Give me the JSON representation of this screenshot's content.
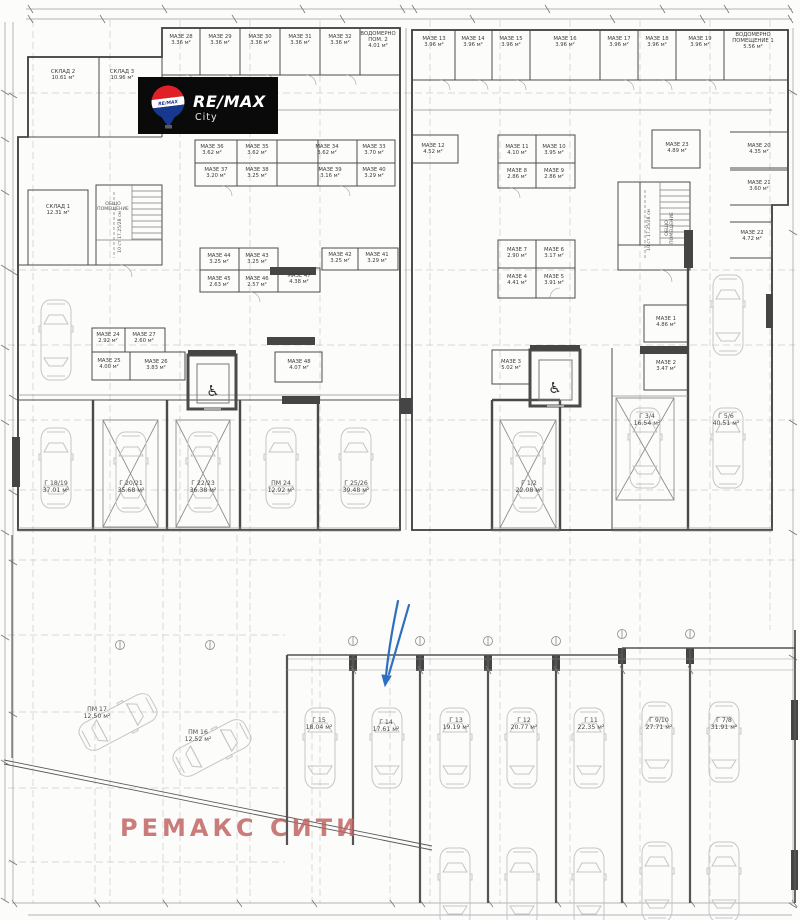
{
  "brand": {
    "logo_text": "RE/MAX",
    "logo_sub": "City",
    "balloon_text": "RE/MAX",
    "colors": {
      "red": "#e01f26",
      "blue": "#16388e",
      "black": "#0a0a0a"
    }
  },
  "watermark": {
    "text": "РЕМАКС СИТИ",
    "color": "#c06060"
  },
  "annotation": {
    "arrow_color": "#2f6fc0"
  },
  "plan": {
    "rooms": [
      {
        "label": "СКЛАД 2",
        "area": "10.61 м²",
        "x": 63,
        "y": 73
      },
      {
        "label": "СКЛАД 3",
        "area": "10.96 м²",
        "x": 122,
        "y": 73
      },
      {
        "label": "СКЛАД 1",
        "area": "12.31 м²",
        "x": 58,
        "y": 208
      },
      {
        "label": "МАЗЕ 28",
        "area": "3.36 м²",
        "x": 181,
        "y": 38
      },
      {
        "label": "МАЗЕ 29",
        "area": "3.36 м²",
        "x": 220,
        "y": 38
      },
      {
        "label": "МАЗЕ 30",
        "area": "3.36 м²",
        "x": 260,
        "y": 38
      },
      {
        "label": "МАЗЕ 31",
        "area": "3.36 м²",
        "x": 300,
        "y": 38
      },
      {
        "label": "МАЗЕ 32",
        "area": "3.36 м²",
        "x": 340,
        "y": 38
      },
      {
        "label": "ВОДОМЕРНО",
        "label2": "ПОМ. 2",
        "area": "4.01 м²",
        "x": 378,
        "y": 35
      },
      {
        "label": "МАЗЕ 13",
        "area": "3.96 м²",
        "x": 434,
        "y": 40
      },
      {
        "label": "МАЗЕ 14",
        "area": "3.96 м²",
        "x": 473,
        "y": 40
      },
      {
        "label": "МАЗЕ 15",
        "area": "3.96 м²",
        "x": 511,
        "y": 40
      },
      {
        "label": "МАЗЕ 16",
        "area": "3.96 м²",
        "x": 565,
        "y": 40
      },
      {
        "label": "МАЗЕ 17",
        "area": "3.96 м²",
        "x": 619,
        "y": 40
      },
      {
        "label": "МАЗЕ 18",
        "area": "3.96 м²",
        "x": 657,
        "y": 40
      },
      {
        "label": "МАЗЕ 19",
        "area": "3.96 м²",
        "x": 700,
        "y": 40
      },
      {
        "label": "ВОДОМЕРНО",
        "label2": "ПОМЕЩЕНИЕ 1",
        "area": "5.56 м²",
        "x": 753,
        "y": 36
      },
      {
        "label": "МАЗЕ 36",
        "area": "3.62 м²",
        "x": 212,
        "y": 148
      },
      {
        "label": "МАЗЕ 35",
        "area": "3.62 м²",
        "x": 257,
        "y": 148
      },
      {
        "label": "МАЗЕ 34",
        "area": "3.62 м²",
        "x": 327,
        "y": 148
      },
      {
        "label": "МАЗЕ 33",
        "area": "3.70 м²",
        "x": 374,
        "y": 148
      },
      {
        "label": "МАЗЕ 37",
        "area": "3.20 м²",
        "x": 216,
        "y": 171
      },
      {
        "label": "МАЗЕ 38",
        "area": "3.25 м²",
        "x": 257,
        "y": 171
      },
      {
        "label": "МАЗЕ 39",
        "area": "3.16 м²",
        "x": 330,
        "y": 171
      },
      {
        "label": "МАЗЕ 40",
        "area": "3.29 м²",
        "x": 374,
        "y": 171
      },
      {
        "label": "МАЗЕ 12",
        "area": "4.52 м²",
        "x": 433,
        "y": 147
      },
      {
        "label": "МАЗЕ 11",
        "area": "4.10 м²",
        "x": 517,
        "y": 148
      },
      {
        "label": "МАЗЕ 10",
        "area": "3.95 м²",
        "x": 554,
        "y": 148
      },
      {
        "label": "МАЗЕ 8",
        "area": "2.86 м²",
        "x": 517,
        "y": 172
      },
      {
        "label": "МАЗЕ 9",
        "area": "2.86 м²",
        "x": 554,
        "y": 172
      },
      {
        "label": "МАЗЕ 23",
        "area": "4.89 м²",
        "x": 677,
        "y": 146
      },
      {
        "label": "МАЗЕ 20",
        "area": "4.35 м²",
        "x": 759,
        "y": 147
      },
      {
        "label": "МАЗЕ 21",
        "area": "3.60 м²",
        "x": 759,
        "y": 184
      },
      {
        "label": "МАЗЕ 22",
        "area": "4.72 м²",
        "x": 752,
        "y": 234
      },
      {
        "label": "МАЗЕ 44",
        "area": "3.25 м²",
        "x": 219,
        "y": 257
      },
      {
        "label": "МАЗЕ 43",
        "area": "3.25 м²",
        "x": 257,
        "y": 257
      },
      {
        "label": "МАЗЕ 42",
        "area": "3.25 м²",
        "x": 340,
        "y": 256
      },
      {
        "label": "МАЗЕ 41",
        "area": "3.29 м²",
        "x": 377,
        "y": 256
      },
      {
        "label": "МАЗЕ 45",
        "area": "2.63 м²",
        "x": 219,
        "y": 280
      },
      {
        "label": "МАЗЕ 46",
        "area": "2.57 м²",
        "x": 257,
        "y": 280
      },
      {
        "label": "МАЗЕ 47",
        "area": "4.38 м²",
        "x": 299,
        "y": 277
      },
      {
        "label": "МАЗЕ 7",
        "area": "2.90 м²",
        "x": 517,
        "y": 251
      },
      {
        "label": "МАЗЕ 6",
        "area": "3.17 м²",
        "x": 554,
        "y": 251
      },
      {
        "label": "МАЗЕ 4",
        "area": "4.41 м²",
        "x": 517,
        "y": 278
      },
      {
        "label": "МАЗЕ 5",
        "area": "3.91 м²",
        "x": 554,
        "y": 278
      },
      {
        "label": "МАЗЕ 24",
        "area": "2.92 м²",
        "x": 108,
        "y": 336
      },
      {
        "label": "МАЗЕ 27",
        "area": "2.60 м²",
        "x": 144,
        "y": 336
      },
      {
        "label": "МАЗЕ 25",
        "area": "4.00 м²",
        "x": 109,
        "y": 362
      },
      {
        "label": "МАЗЕ 26",
        "area": "3.83 м²",
        "x": 156,
        "y": 363
      },
      {
        "label": "МАЗЕ 48",
        "area": "4.07 м²",
        "x": 299,
        "y": 363
      },
      {
        "label": "МАЗЕ 3",
        "area": "5.02 м²",
        "x": 511,
        "y": 363
      },
      {
        "label": "МАЗЕ 1",
        "area": "4.86 м²",
        "x": 666,
        "y": 320
      },
      {
        "label": "МАЗЕ 2",
        "area": "3.47 м²",
        "x": 666,
        "y": 364
      }
    ],
    "garages": [
      {
        "label": "Г 18/19",
        "area": "37.01 м²",
        "x": 56,
        "y": 485
      },
      {
        "label": "Г 20/21",
        "area": "35.68 м²",
        "x": 131,
        "y": 485
      },
      {
        "label": "Г 22/23",
        "area": "36.38 м²",
        "x": 203,
        "y": 485
      },
      {
        "label": "ПМ 24",
        "area": "12.92 м²",
        "x": 281,
        "y": 485
      },
      {
        "label": "Г 25/26",
        "area": "39.48 м²",
        "x": 356,
        "y": 485
      },
      {
        "label": "Г 1/2",
        "area": "22.08 м²",
        "x": 529,
        "y": 485
      },
      {
        "label": "Г 3/4",
        "area": "16.54 м²",
        "x": 647,
        "y": 418
      },
      {
        "label": "Г 5/6",
        "area": "40.51 м²",
        "x": 726,
        "y": 418
      },
      {
        "label": "ПМ 17",
        "area": "12.50 м²",
        "x": 97,
        "y": 711
      },
      {
        "label": "ПМ 16",
        "area": "12.52 м²",
        "x": 198,
        "y": 734
      },
      {
        "label": "Г 15",
        "area": "18.04 м²",
        "x": 319,
        "y": 722
      },
      {
        "label": "Г 14",
        "area": "17.61 м²",
        "x": 386,
        "y": 724
      },
      {
        "label": "Г 13",
        "area": "19.19 м²",
        "x": 456,
        "y": 722
      },
      {
        "label": "Г 12",
        "area": "20.77 м²",
        "x": 524,
        "y": 722
      },
      {
        "label": "Г 11",
        "area": "22.35 м²",
        "x": 591,
        "y": 722
      },
      {
        "label": "Г 9/10",
        "area": "27.71 м²",
        "x": 659,
        "y": 722
      },
      {
        "label": "Г 7/8",
        "area": "31.91 м²",
        "x": 724,
        "y": 722
      }
    ],
    "notes": [
      {
        "lines": [
          "ОБЩО",
          "ПОМЕЩЕНИЕ"
        ],
        "x": 113,
        "y": 205,
        "rot": 0
      },
      {
        "lines": [
          "10 ст 17.25/28 см"
        ],
        "x": 121,
        "y": 232,
        "rot": -90
      },
      {
        "lines": [
          "ОБЩО",
          "ПОМЕЩЕНИЕ"
        ],
        "x": 668,
        "y": 228,
        "rot": -90
      },
      {
        "lines": [
          "10 ст 17.25/28 см"
        ],
        "x": 650,
        "y": 230,
        "rot": -90
      }
    ]
  }
}
